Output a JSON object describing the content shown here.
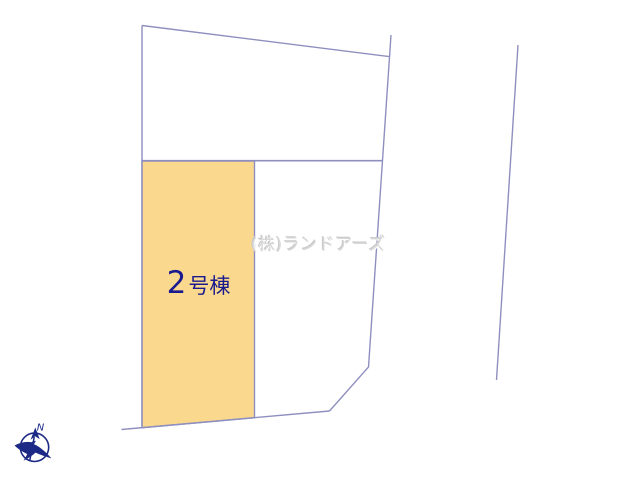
{
  "diagram": {
    "lot_label": {
      "number": "2",
      "suffix": "号棟"
    },
    "watermark": "(株)ランドアーズ",
    "compass": {
      "north_label": "N"
    }
  },
  "colors": {
    "background": "#FFFFFF",
    "boundary-line": "#8F8FBF",
    "lot-fill": "#FAD98F",
    "lot-label": "#1A1A8E",
    "compass": "#1C2A86",
    "watermark": "#D8D8D8"
  }
}
